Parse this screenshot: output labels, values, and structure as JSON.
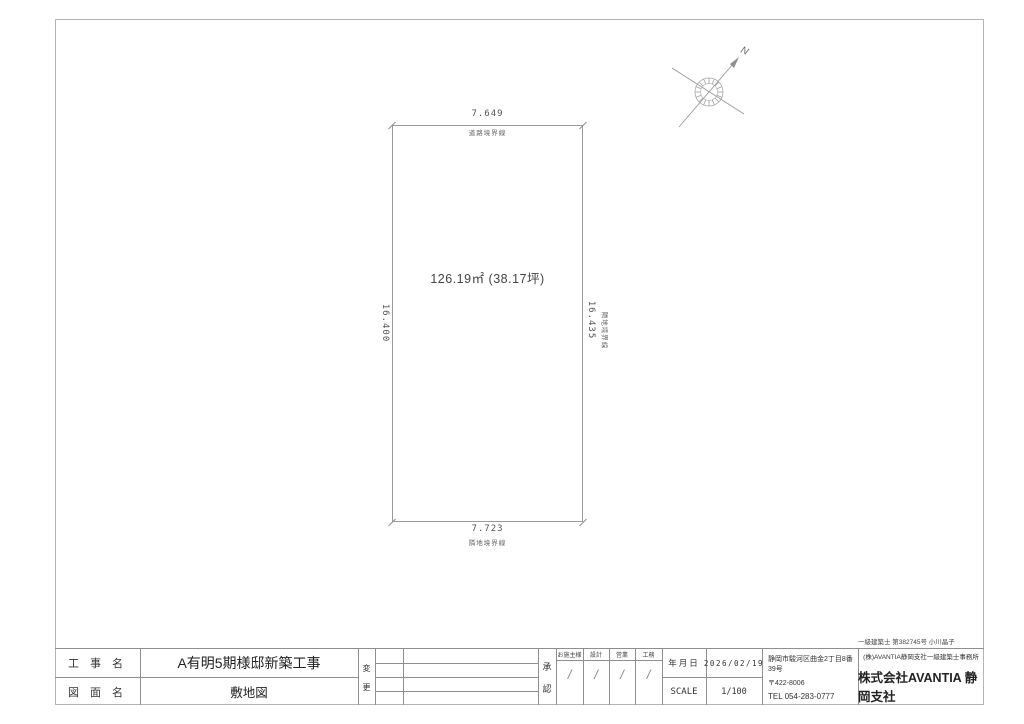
{
  "sheet": {
    "license_text": "一級建築士 第382745号 小川晶子"
  },
  "site_plan": {
    "area_text": "126.19㎡ (38.17坪)",
    "north_label": "N",
    "dims": {
      "top": "7.649",
      "bottom": "7.723",
      "left": "16.400",
      "right": "16.435"
    },
    "boundary_labels": {
      "top": "道路境界線",
      "bottom": "隣地境界線",
      "right": "隣地境界線"
    }
  },
  "title_block": {
    "project_label": "工 事 名",
    "project_value": "A有明5期様邸新築工事",
    "drawing_label": "図 面 名",
    "drawing_value": "敷地図",
    "revision_label": {
      "top": "変",
      "bottom": "更"
    },
    "approval_label": {
      "top": "承",
      "bottom": "認"
    },
    "approval_columns": [
      {
        "label": "お施主様",
        "mark": "/"
      },
      {
        "label": "設計",
        "mark": "/"
      },
      {
        "label": "営業",
        "mark": "/"
      },
      {
        "label": "工務",
        "mark": "/"
      }
    ],
    "date_label": "年月日",
    "date_value": "2026/02/19",
    "scale_label": "SCALE",
    "scale_value": "1/100",
    "office": {
      "address": "静岡市駿河区曲金2丁目8番39号",
      "postal": "〒422-8006",
      "tel": "TEL  054-283-0777"
    },
    "company": {
      "office_line": "(株)AVANTIA静岡支社一級建築士事務所",
      "name": "株式会社AVANTIA 静岡支社"
    }
  },
  "colors": {
    "line": "#9a9a9a",
    "text": "#3c3c3c"
  }
}
